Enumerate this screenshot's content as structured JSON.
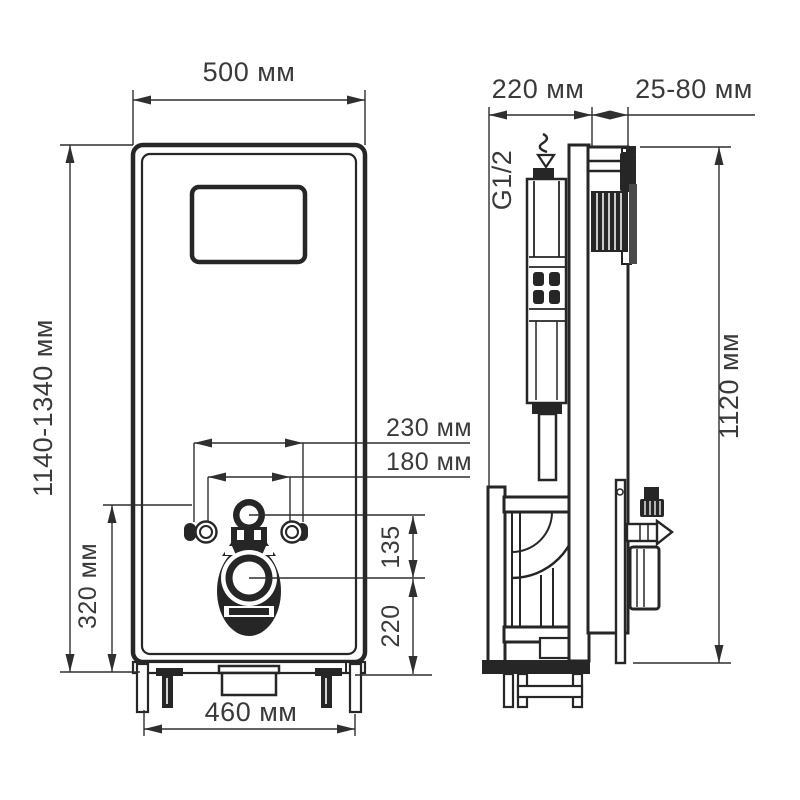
{
  "drawing": {
    "front_view": {
      "dim_width": "500 мм",
      "dim_height_range": "1140-1340 мм",
      "dim_inlet_height": "320 мм",
      "dim_fixing_outer": "230 мм",
      "dim_fixing_inner": "180 мм",
      "dim_inlet_to_outlet": "135",
      "dim_outlet_to_floor": "220",
      "dim_base_width": "460 мм"
    },
    "side_view": {
      "dim_depth": "220 мм",
      "dim_wall_offset": "25-80 мм",
      "dim_frame_height": "1120 мм",
      "water_connection_label": "G1/2"
    },
    "line_color": "#262626",
    "background": "#ffffff"
  }
}
